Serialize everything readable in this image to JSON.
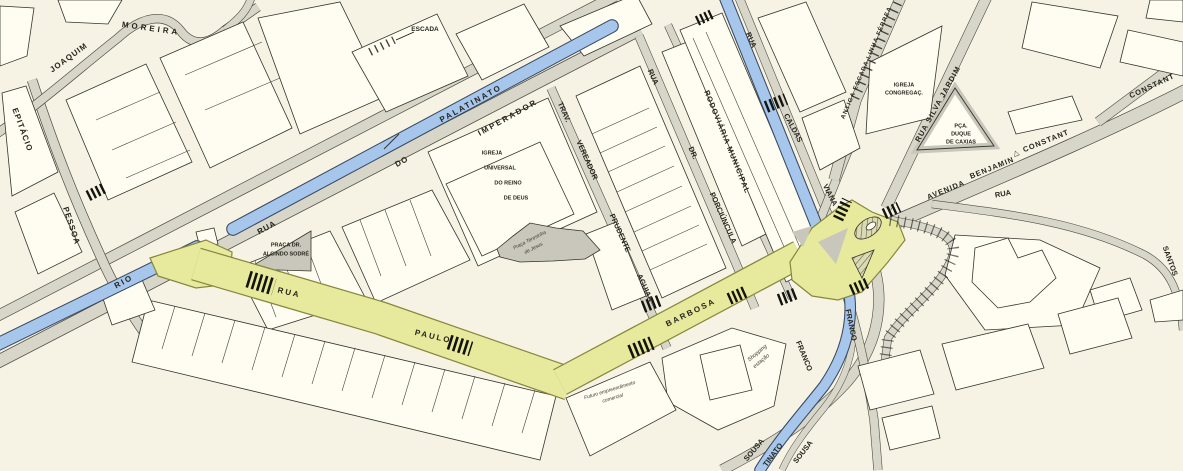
{
  "colors": {
    "paper": "#f7f3e4",
    "road": "#d8d5c9",
    "canal_water": "#a6c6ec",
    "highlight_street": "#e7e99c",
    "plaza": "#c9c6bb",
    "building": "#fffdf2",
    "outline": "#34342b",
    "crosswalk": "#14140f"
  },
  "labels": [
    {
      "text": "JOAQUIM"
    },
    {
      "text": "MOREIRA"
    },
    {
      "text": "EPITÁCIO"
    },
    {
      "text": "PESSOA"
    },
    {
      "text": "RIO"
    },
    {
      "text": "RUA"
    },
    {
      "text": "DO"
    },
    {
      "text": "PALATINATO"
    },
    {
      "text": "IMPERADOR"
    },
    {
      "text": "ESCADA"
    },
    {
      "text": "TRAV."
    },
    {
      "text": "VEREADOR"
    },
    {
      "text": "PRUDENTE"
    },
    {
      "text": "AGUIAR"
    },
    {
      "text": "RUA"
    },
    {
      "text": "DR."
    },
    {
      "text": "PORCIÚNCULA"
    },
    {
      "text": "RODOVIÁRIA MUNICIPAL"
    },
    {
      "text": "RUA"
    },
    {
      "text": "CALDAS"
    },
    {
      "text": "VIANA"
    },
    {
      "text": "ANTIGA ESCADA LINHA FÉRREA"
    },
    {
      "text": "IGREJA"
    },
    {
      "text": "CONGREGAÇ."
    },
    {
      "text": "RUA SILVA JARDIM"
    },
    {
      "text": "PÇA."
    },
    {
      "text": "DUQUE"
    },
    {
      "text": "DE CAXIAS"
    },
    {
      "text": "AVENIDA"
    },
    {
      "text": "BENJAMIN"
    },
    {
      "text": "△"
    },
    {
      "text": "CONSTANT"
    },
    {
      "text": "CONSTANT"
    },
    {
      "text": "RUA"
    },
    {
      "text": "SANTOS"
    },
    {
      "text": "PRAÇA DR."
    },
    {
      "text": "ALCINDO SODRÉ"
    },
    {
      "text": "RUA"
    },
    {
      "text": "PAULO"
    },
    {
      "text": "BARBOSA"
    },
    {
      "text": "Praça Teresinha"
    },
    {
      "text": "de Jesus"
    },
    {
      "text": "IGREJA"
    },
    {
      "text": "UNIVERSAL"
    },
    {
      "text": "DO REINO"
    },
    {
      "text": "DE DEUS"
    },
    {
      "text": "Shopping"
    },
    {
      "text": "estação"
    },
    {
      "text": "Futuro empreendimento"
    },
    {
      "text": "comercial"
    },
    {
      "text": "FRANCO"
    },
    {
      "text": "FRANCO"
    },
    {
      "text": "SOUSA"
    },
    {
      "text": "TINATO"
    },
    {
      "text": "SOUSA"
    }
  ]
}
